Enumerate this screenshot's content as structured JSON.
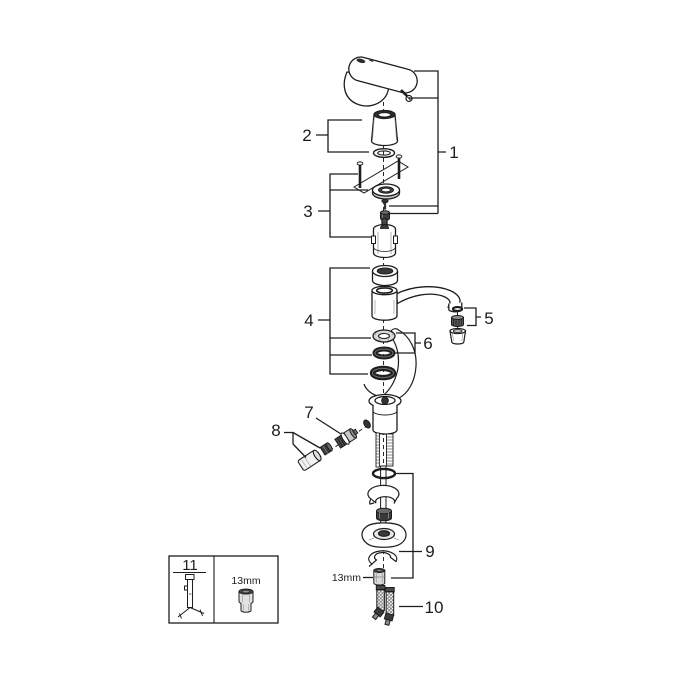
{
  "colors": {
    "line": "#1d1d1d",
    "background": "#ffffff",
    "dark_fill": "#3d3d3d",
    "mid_gray": "#9a9a9a",
    "light_gray": "#e2e2e2"
  },
  "labels": {
    "n1": "1",
    "n2": "2",
    "n3": "3",
    "n4": "4",
    "n5": "5",
    "n6": "6",
    "n7": "7",
    "n8": "8",
    "n9": "9",
    "n10": "10",
    "n11": "11"
  },
  "annotations": {
    "wrench_inline": "13mm",
    "wrench_box": "13mm"
  }
}
